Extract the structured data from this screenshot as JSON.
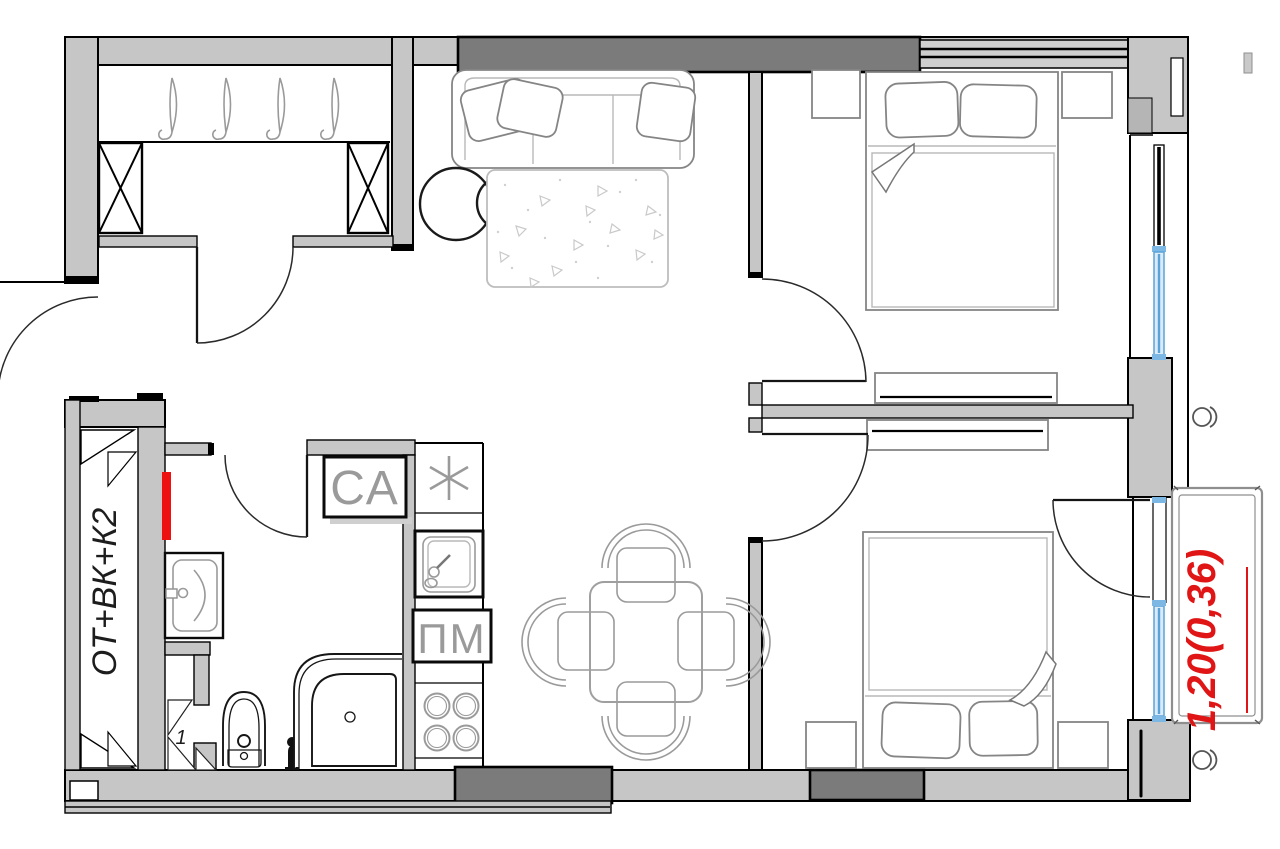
{
  "plan": {
    "type": "apartment-floor-plan",
    "labels": {
      "riser_shaft": "ОТ+ВК+К2",
      "washing_machine": "СА",
      "dishwasher": "ПМ",
      "shaft_unit_number": "1",
      "balcony_dimension": "1,20(0,36)"
    }
  },
  "colors": {
    "wall_fill": "#c6c6c6",
    "wall_dark": "#7b7b7b",
    "outline": "#000000",
    "furniture_line": "#9a9a9a",
    "dimension_red": "#e01515",
    "towel_rail_red": "#ee1111",
    "window_blue": "#5aa3d8",
    "window_blue_light": "#7db7e4",
    "window_glass_fill": "#ddebf7"
  }
}
